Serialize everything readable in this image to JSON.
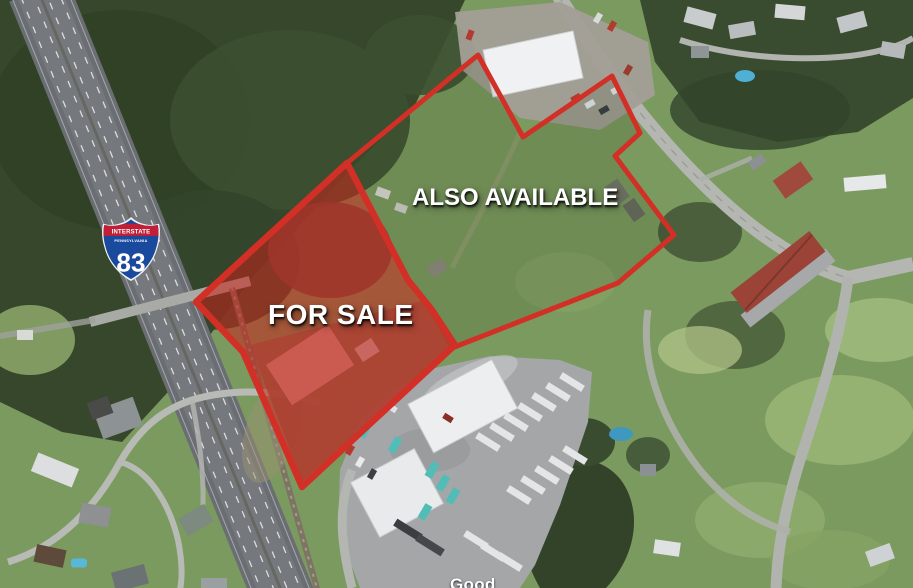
{
  "parcels": {
    "for_sale": {
      "label": "FOR SALE"
    },
    "also_available": {
      "label": "ALSO AVAILABLE"
    }
  },
  "highway_shield": {
    "top_text": "INTERSTATE",
    "state_text": "PENNSYLVANIA",
    "route_number": "83"
  },
  "basemap": {
    "partial_place_label": "Good"
  },
  "colors": {
    "parcel_outline": "#d22f26",
    "for_sale_fill": "rgba(200,32,26,0.55)",
    "also_available_fill": "rgba(25,40,15,0.12)",
    "shield_banner": "#c01f35",
    "shield_field": "#1a4a9e",
    "label_text": "#ffffff"
  }
}
